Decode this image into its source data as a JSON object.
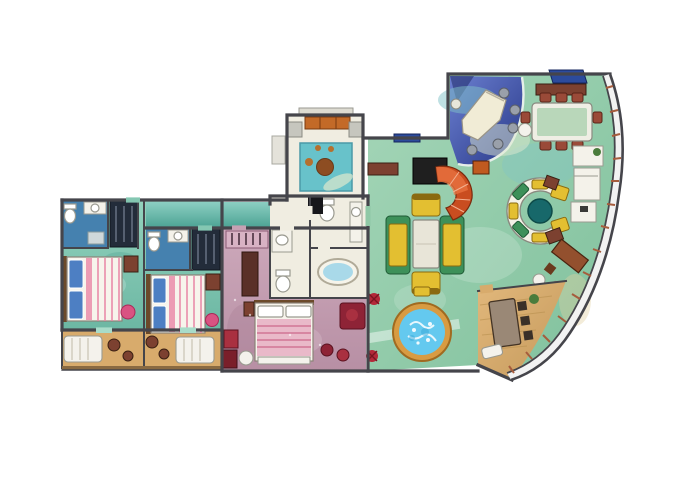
{
  "illustration": {
    "type": "cruise-ship-suite-floor-plan",
    "rooms": [
      "guest-bedroom-1",
      "guest-bathroom-1",
      "guest-bedroom-2",
      "guest-bathroom-2",
      "guest-balcony-1",
      "guest-balcony-2",
      "hallway",
      "den",
      "entry-hall",
      "master-bedroom",
      "master-bathroom-washroom",
      "wc-room",
      "tub-room",
      "living-room",
      "piano-lounge",
      "dining-area",
      "wet-bar",
      "circular-lounge",
      "spiral-staircase",
      "hot-tub",
      "private-sun-deck"
    ],
    "furnishings": [
      "double-bed",
      "toilet",
      "sink",
      "wardrobe",
      "nightstand",
      "lounge-chair",
      "balcony-table",
      "grand-piano",
      "piano-stools",
      "dining-table",
      "dining-chairs",
      "sideboard",
      "sofa",
      "armchair",
      "coffee-table",
      "round-lounge-sofa",
      "round-table",
      "desk",
      "bathtub",
      "hot-tub",
      "deck-table",
      "plants",
      "ottoman"
    ]
  },
  "palette": {
    "bg": "#ffffff",
    "wall": "#45454b",
    "floor_teal": "#84c7b2",
    "floor_teal_hi": "#a8dcc9",
    "floor_teal_dk": "#57a795",
    "floor_green": "#8fc8a6",
    "floor_aqua": "#7fc2c8",
    "floor_pink": "#c6a1b3",
    "floor_pink_dk": "#a87f95",
    "floor_white": "#f0ede1",
    "floor_wood": "#d8ab6c",
    "wood_dark": "#b8904e",
    "bath_blue": "#4581af",
    "water": "#64c9ef",
    "tub_rim": "#d89b42",
    "bed_white": "#f7f4ec",
    "pillow_blue": "#4d7fc3",
    "stripe_pink": "#e886a6",
    "accent_pink": "#d95382",
    "maroon": "#8e2336",
    "dark_red": "#a93040",
    "sofa_yellow": "#e3bf31",
    "sofa_green": "#3d9059",
    "stair_orange": "#c94d20",
    "stair_orange_hi": "#ea7442",
    "piano_blue_1": "#5a6fc2",
    "piano_blue_2": "#2a3a85",
    "cream": "#f1ecd6",
    "stool_gray": "#9aa0aa",
    "chair_red": "#9a4a38",
    "furn_brown": "#7c4130",
    "table_teal": "#17686a",
    "ring_white": "#f3f1e6",
    "dining_green": "#b9d7ba",
    "mullion": "#a65c3c",
    "hull_white": "#f2f2f2",
    "dark_wardrobe": "#232c3a",
    "cab_orange": "#c36a28",
    "rug_teal": "#68c2ca",
    "rug_brown": "#8d4d22",
    "glass_blue": "#2c4b9c",
    "plant_red": "#b32838",
    "plant_green": "#4a7c3c",
    "gray_ledge": "#dddbd1"
  }
}
